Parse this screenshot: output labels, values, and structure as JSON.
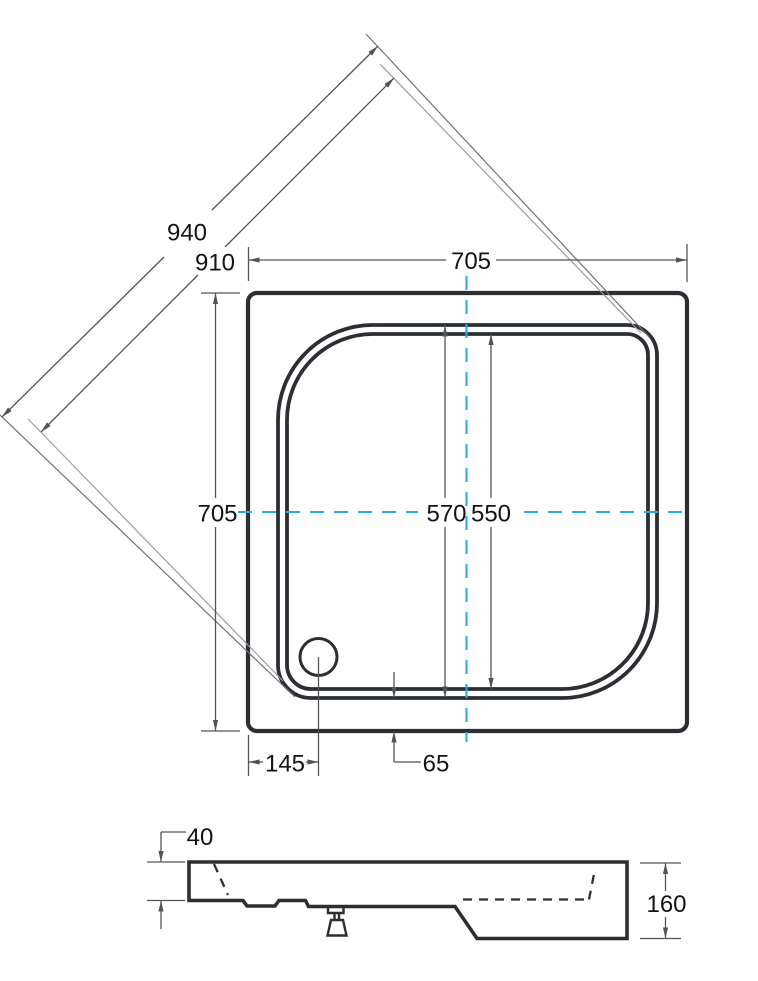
{
  "colors": {
    "background": "#ffffff",
    "line": "#2b2e33",
    "dim": "#515457",
    "ext_dark": "#6f7276",
    "ext_light": "#9b9da1",
    "centerline": "#29abe2",
    "text": "#111316"
  },
  "top_view": {
    "dim_diagonal_outer": "940",
    "dim_diagonal_inner": "910",
    "dim_outer_width": "705",
    "dim_outer_height": "705",
    "dim_basin_top": "570",
    "dim_basin_bottom": "550",
    "dim_drain_offset": "145",
    "dim_rim_gap": "65"
  },
  "side_view": {
    "dim_rim_height": "40",
    "dim_total_height": "160"
  }
}
